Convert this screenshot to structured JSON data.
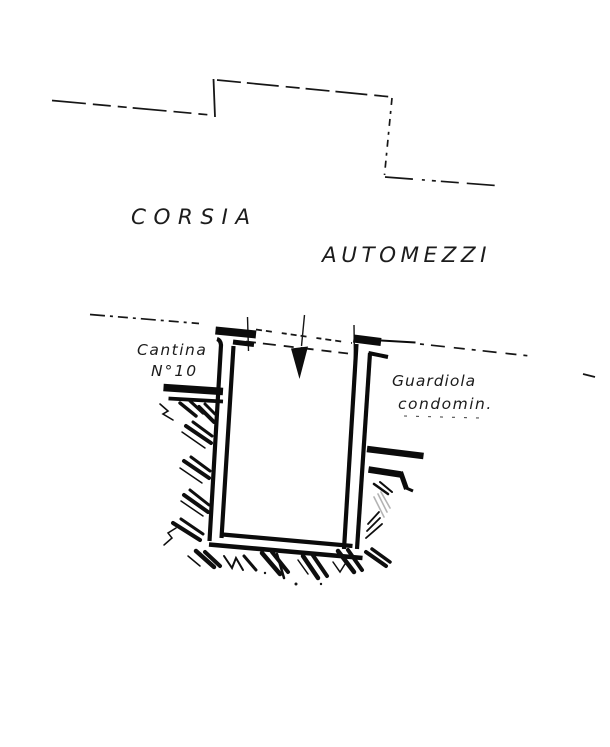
{
  "labels": {
    "corsia": "CORSIA",
    "automezzi": "AUTOMEZZI",
    "cantina_line1": "Cantina",
    "cantina_line2": "N°10",
    "guardiola_line1": "Guardiola",
    "guardiola_line2": "condomin."
  },
  "colors": {
    "ink": "#1c1c1c",
    "paper": "#ffffff"
  }
}
